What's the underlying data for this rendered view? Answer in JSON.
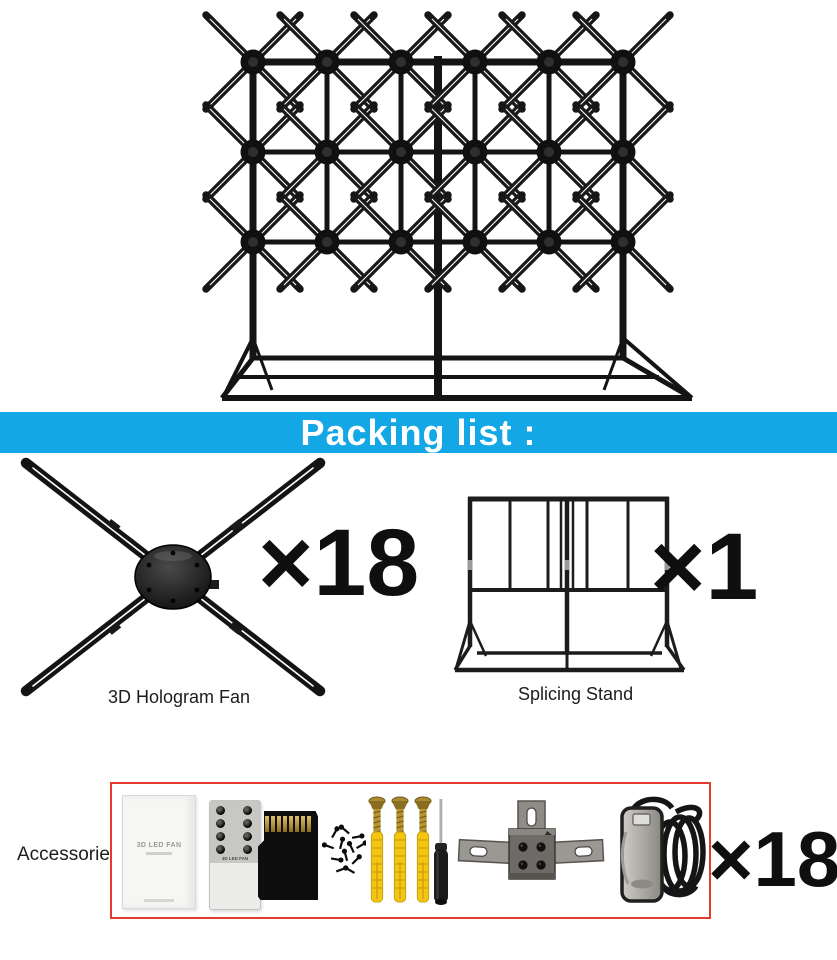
{
  "banner": {
    "title": "Packing list :"
  },
  "packing": {
    "fan": {
      "label": "3D Hologram Fan",
      "qty": "×18"
    },
    "stand": {
      "label": "Splicing Stand",
      "qty": "×1"
    }
  },
  "accessories": {
    "label": "Accessories:",
    "qty": "×18",
    "manual_title": "3D LED FAN",
    "remote_title": "3D LED FAN",
    "item_names": [
      "user-manual-box",
      "remote-control",
      "sd-card",
      "screw-pack",
      "expansion-anchors",
      "screwdriver",
      "mounting-bracket",
      "power-adapter"
    ]
  },
  "colors": {
    "banner_bg": "#14a7e5",
    "banner_text": "#ffffff",
    "accessory_box_border": "#e53a2e",
    "structure_black": "#161616"
  }
}
